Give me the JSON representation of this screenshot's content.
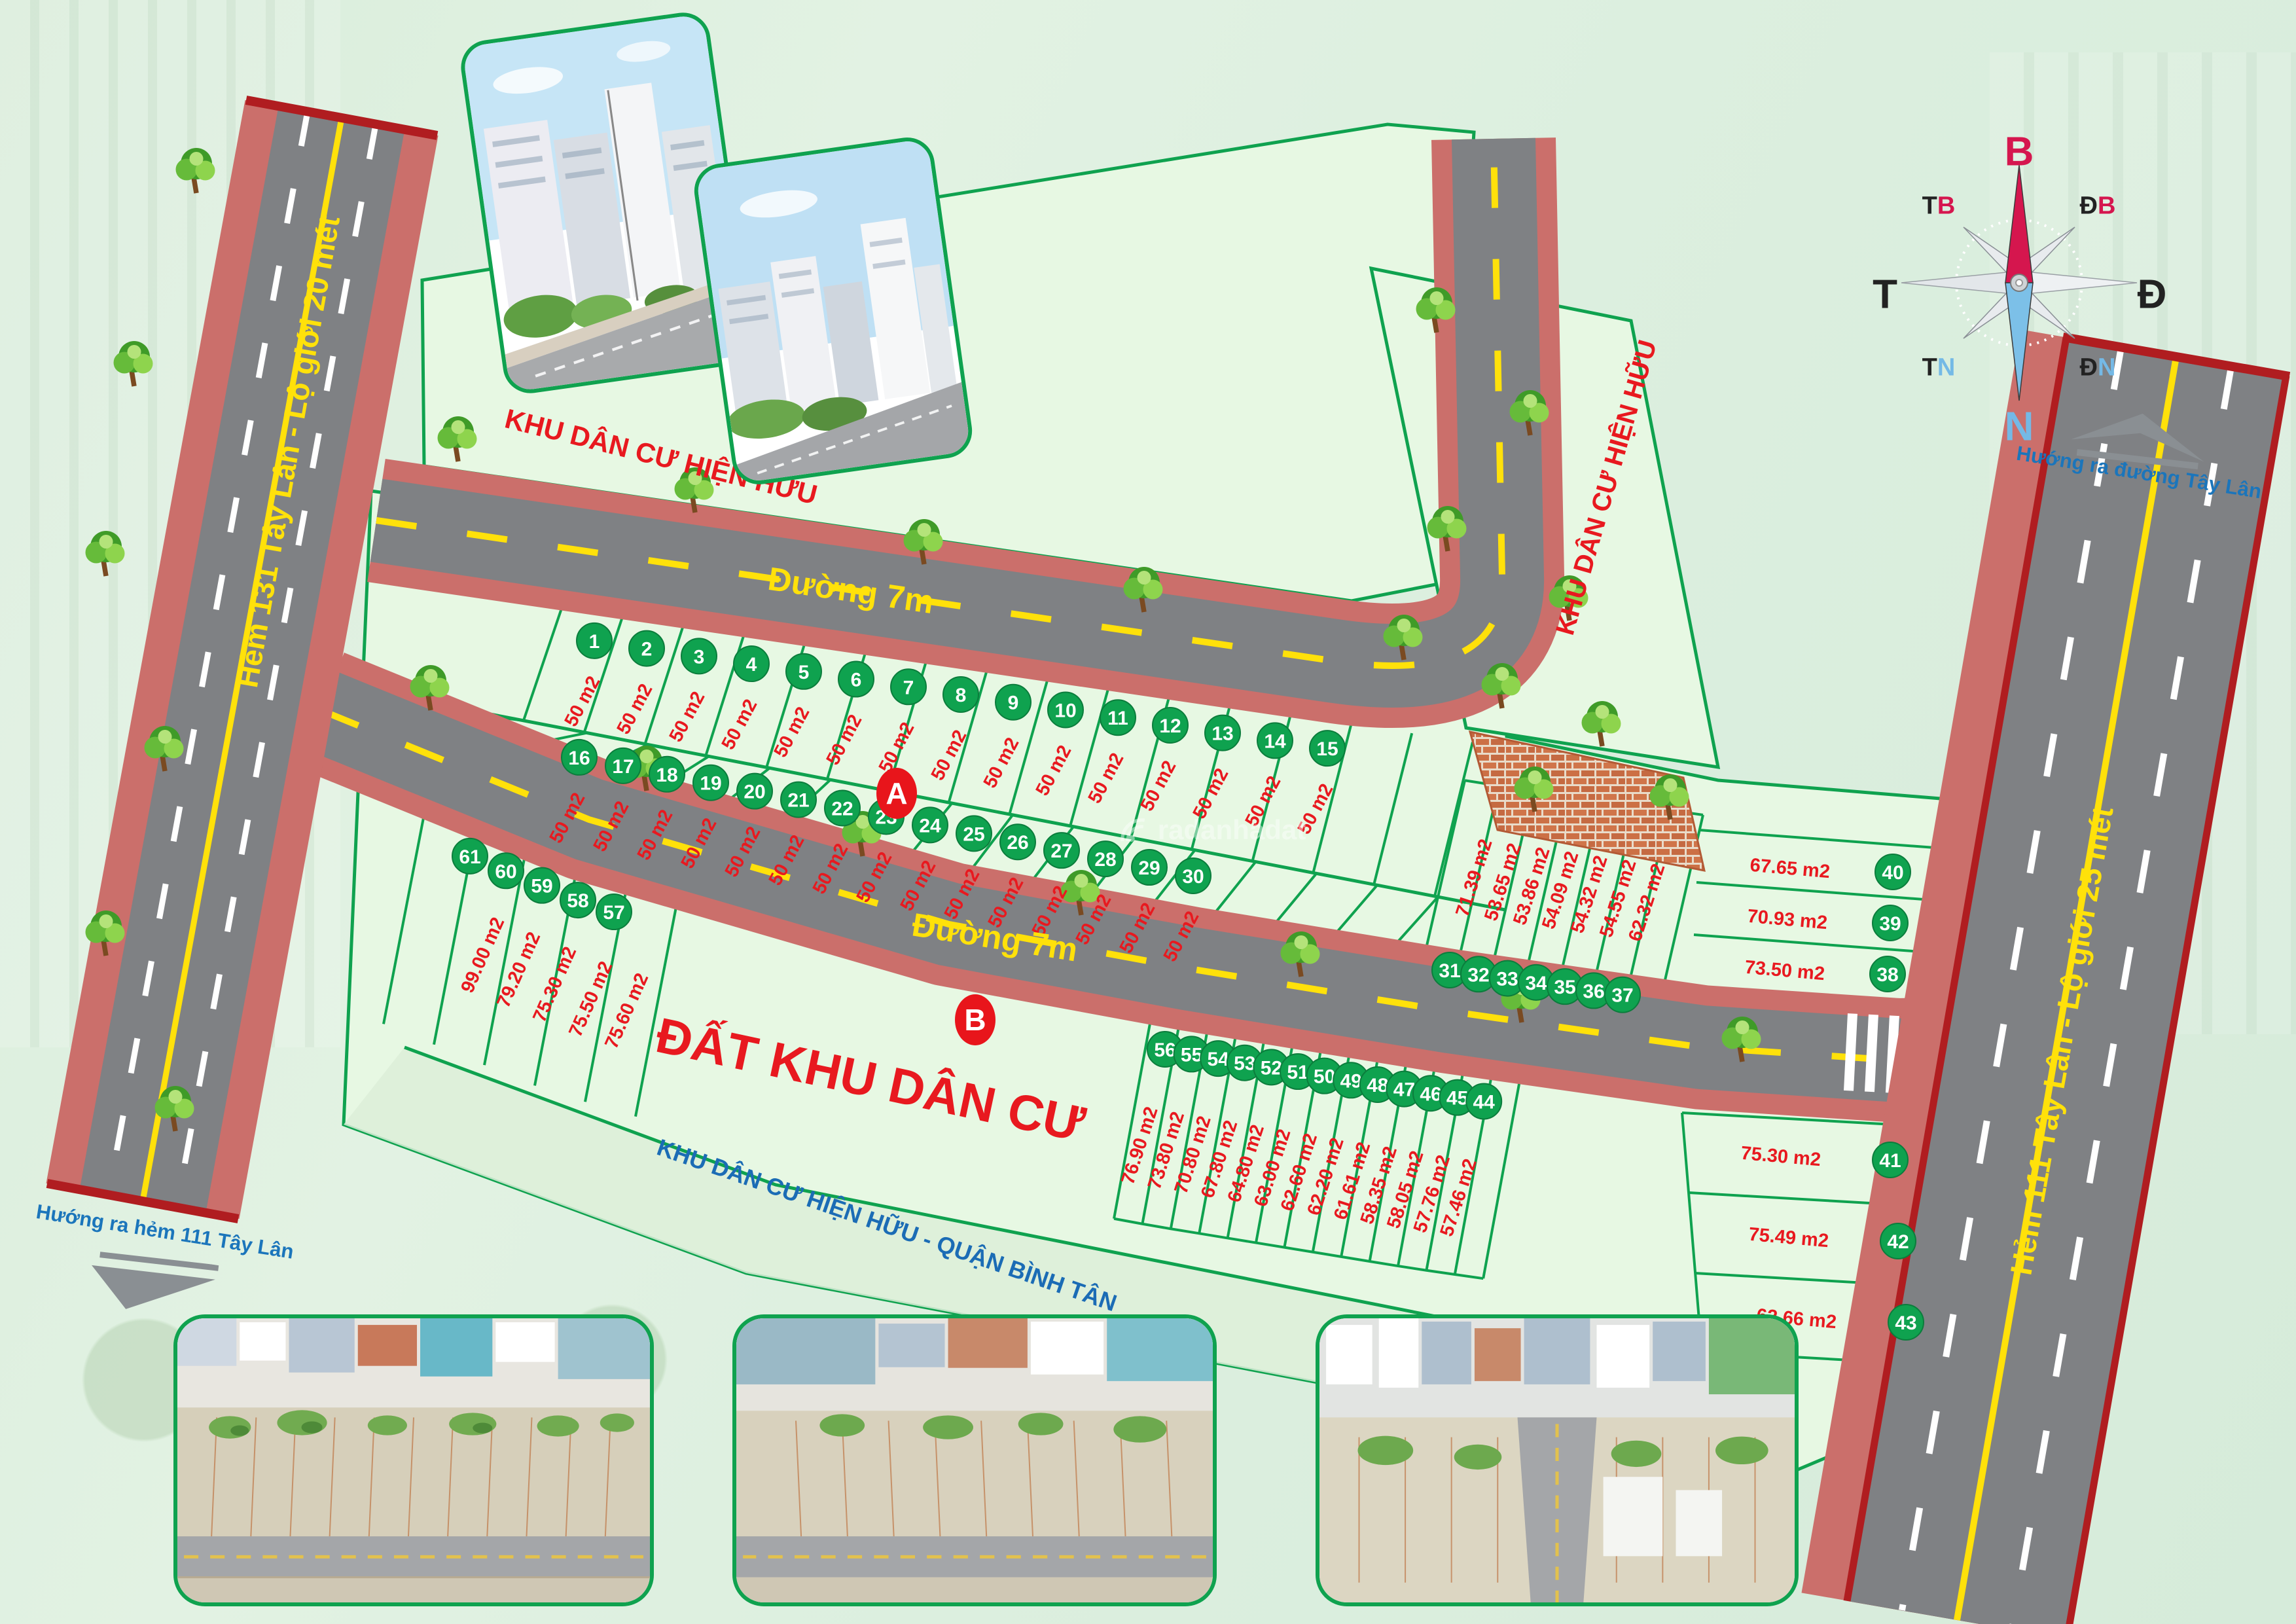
{
  "map": {
    "roads": {
      "left_label": "Hẻm 131 Tây Lân  - Lộ giới 20 mét",
      "right_label": "Hẻm 111 Tây Lân  - Lộ giới 25 mét",
      "street7_upper": "Đường 7m",
      "street7_lower": "Đường 7m"
    },
    "arrows": {
      "top_right": "Hướng ra đường Tây Lân",
      "bottom_left": "Hướng ra hẻm 111 Tây Lân"
    },
    "regions": {
      "top": "KHU DÂN CƯ HIỆN HỮU",
      "top_right": "KHU DÂN CƯ HIỆN HỮU",
      "center": "ĐẤT KHU DÂN CƯ",
      "bottom": "KHU DÂN CƯ HIỆN HỮU - QUẬN BÌNH TÂN"
    },
    "markers": {
      "a": "A",
      "b": "B"
    },
    "watermark": "radanhadat",
    "compass": {
      "n": "B",
      "e": "Đ",
      "s": "N",
      "w": "T",
      "nw": [
        "T",
        "B"
      ],
      "ne": [
        "Đ",
        "B"
      ],
      "sw": [
        "T",
        "N"
      ],
      "se": [
        "Đ",
        "N"
      ]
    },
    "colors": {
      "accent_green": "#0fa24f",
      "area_red": "#e8191f",
      "road_yellow": "#ffe10a",
      "label_blue": "#1b6cb5",
      "sidewalk": "#cb6f6b",
      "asphalt": "#7f8184"
    },
    "plots": [
      {
        "no": 1,
        "area": "50 m2"
      },
      {
        "no": 2,
        "area": "50 m2"
      },
      {
        "no": 3,
        "area": "50 m2"
      },
      {
        "no": 4,
        "area": "50 m2"
      },
      {
        "no": 5,
        "area": "50 m2"
      },
      {
        "no": 6,
        "area": "50 m2"
      },
      {
        "no": 7,
        "area": "50 m2"
      },
      {
        "no": 8,
        "area": "50 m2"
      },
      {
        "no": 9,
        "area": "50 m2"
      },
      {
        "no": 10,
        "area": "50 m2"
      },
      {
        "no": 11,
        "area": "50 m2"
      },
      {
        "no": 12,
        "area": "50 m2"
      },
      {
        "no": 13,
        "area": "50 m2"
      },
      {
        "no": 14,
        "area": "50 m2"
      },
      {
        "no": 15,
        "area": "50 m2"
      },
      {
        "no": 16,
        "area": "50 m2"
      },
      {
        "no": 17,
        "area": "50 m2"
      },
      {
        "no": 18,
        "area": "50 m2"
      },
      {
        "no": 19,
        "area": "50 m2"
      },
      {
        "no": 20,
        "area": "50 m2"
      },
      {
        "no": 21,
        "area": "50 m2"
      },
      {
        "no": 22,
        "area": "50 m2"
      },
      {
        "no": 23,
        "area": "50 m2"
      },
      {
        "no": 24,
        "area": "50 m2"
      },
      {
        "no": 25,
        "area": "50 m2"
      },
      {
        "no": 26,
        "area": "50 m2"
      },
      {
        "no": 27,
        "area": "50 m2"
      },
      {
        "no": 28,
        "area": "50 m2"
      },
      {
        "no": 29,
        "area": "50 m2"
      },
      {
        "no": 30,
        "area": "50 m2"
      },
      {
        "no": 31,
        "area": "71.39 m2"
      },
      {
        "no": 32,
        "area": "53.65 m2"
      },
      {
        "no": 33,
        "area": "53.86 m2"
      },
      {
        "no": 34,
        "area": "54.09 m2"
      },
      {
        "no": 35,
        "area": "54.32 m2"
      },
      {
        "no": 36,
        "area": "54.55 m2"
      },
      {
        "no": 37,
        "area": "62.32 m2"
      },
      {
        "no": 38,
        "area": "73.50 m2"
      },
      {
        "no": 39,
        "area": "70.93 m2"
      },
      {
        "no": 40,
        "area": "67.65 m2"
      },
      {
        "no": 41,
        "area": "75.30 m2"
      },
      {
        "no": 42,
        "area": "75.49 m2"
      },
      {
        "no": 43,
        "area": "62.66 m2"
      },
      {
        "no": 44,
        "area": "57.46 m2"
      },
      {
        "no": 45,
        "area": "57.76 m2"
      },
      {
        "no": 46,
        "area": "58.05 m2"
      },
      {
        "no": 47,
        "area": "58.35 m2"
      },
      {
        "no": 48,
        "area": "61.61 m2"
      },
      {
        "no": 49,
        "area": "62.20 m2"
      },
      {
        "no": 50,
        "area": "62.60 m2"
      },
      {
        "no": 51,
        "area": "63.00 m2"
      },
      {
        "no": 52,
        "area": "64.80 m2"
      },
      {
        "no": 53,
        "area": "67.80 m2"
      },
      {
        "no": 54,
        "area": "70.80 m2"
      },
      {
        "no": 55,
        "area": "73.80 m2"
      },
      {
        "no": 56,
        "area": "76.90 m2"
      },
      {
        "no": 57,
        "area": "75.60 m2"
      },
      {
        "no": 58,
        "area": "75.50 m2"
      },
      {
        "no": 59,
        "area": "75.30 m2"
      },
      {
        "no": 60,
        "area": "79.20 m2"
      },
      {
        "no": 61,
        "area": "99.00 m2"
      }
    ]
  }
}
